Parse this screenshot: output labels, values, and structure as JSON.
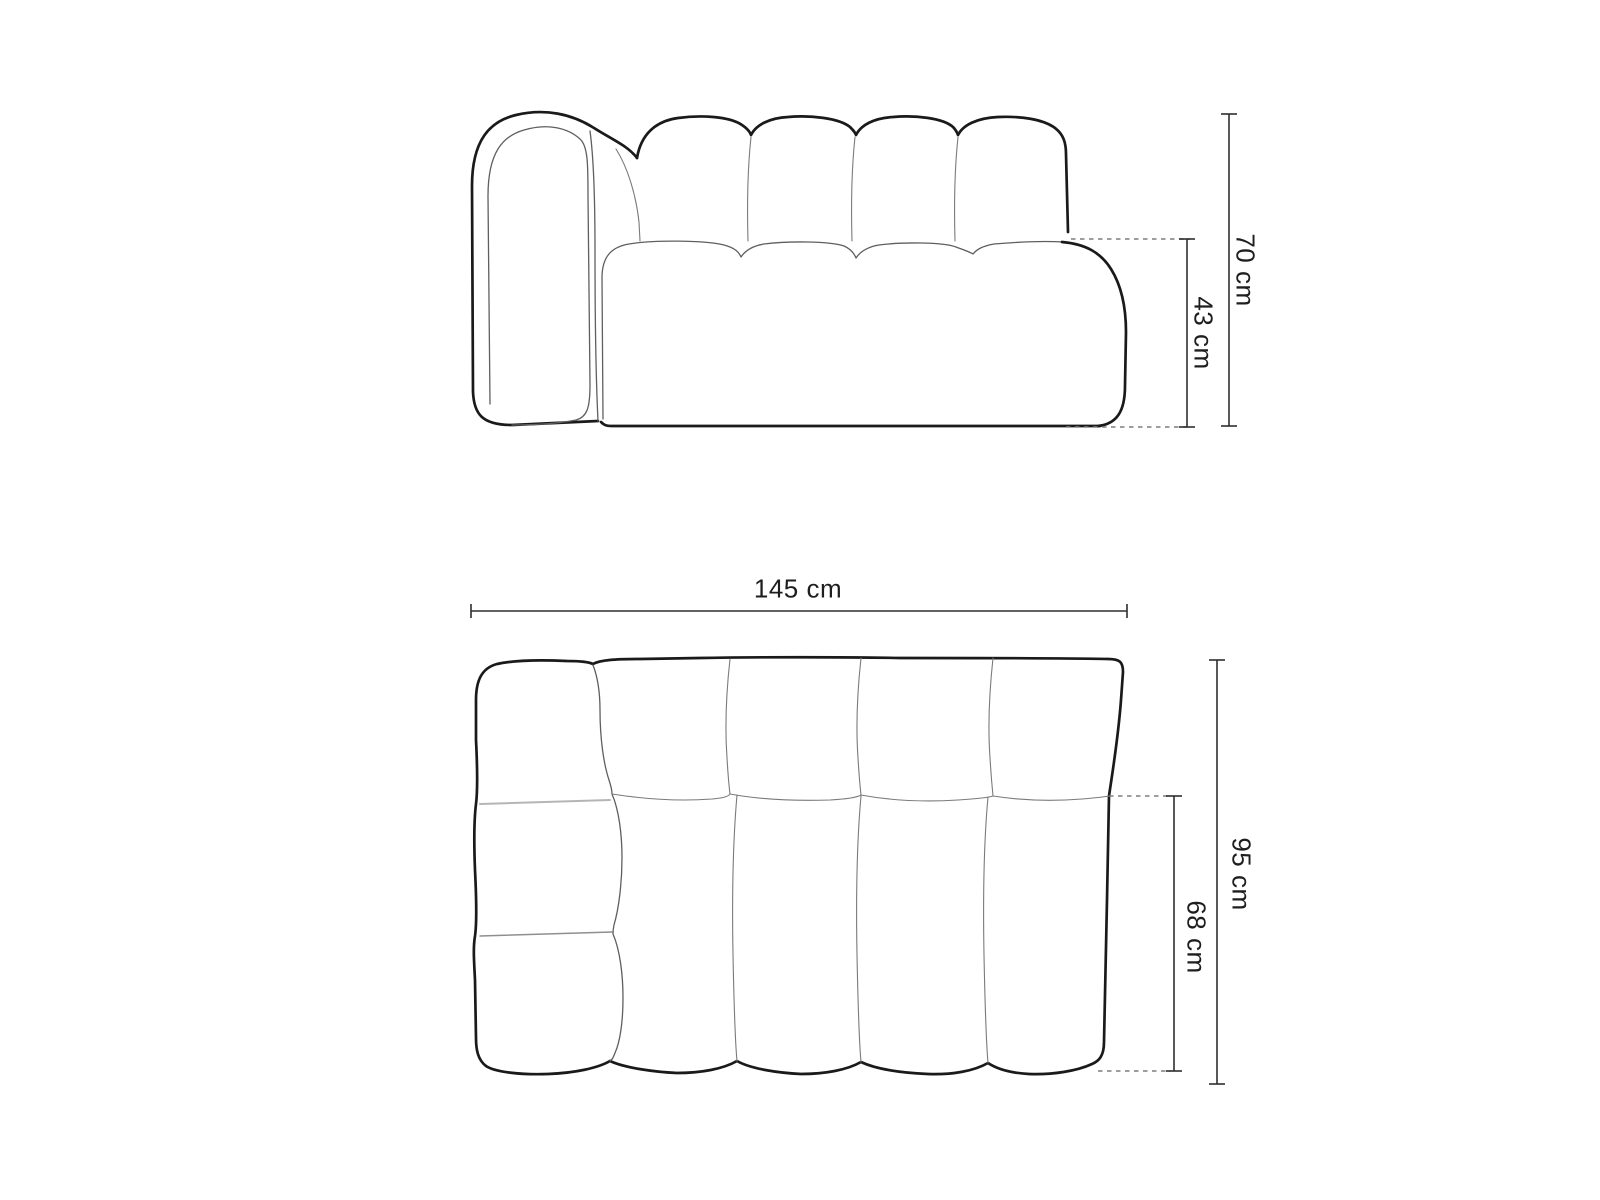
{
  "canvas": {
    "width": 1600,
    "height": 1200,
    "background": "#ffffff"
  },
  "diagram": {
    "subject": "modular sofa technical dimension drawing",
    "views": {
      "front": {
        "name": "front elevation",
        "labels": {
          "overall_height": "70 cm",
          "seat_height": "43 cm"
        }
      },
      "plan": {
        "name": "top view",
        "labels": {
          "overall_width": "145 cm",
          "overall_depth": "95 cm",
          "seat_depth": "68 cm"
        }
      }
    },
    "dimensions_cm": {
      "overall_height": 70,
      "seat_height": 43,
      "overall_width": 145,
      "overall_depth": 95,
      "seat_depth": 68
    },
    "colors": {
      "outline": "#1a1a1a",
      "seam": "#5f5f5f",
      "dimension_line": "#2e2e2e",
      "dashed_extension": "#7d7d7d",
      "background": "#ffffff"
    }
  }
}
